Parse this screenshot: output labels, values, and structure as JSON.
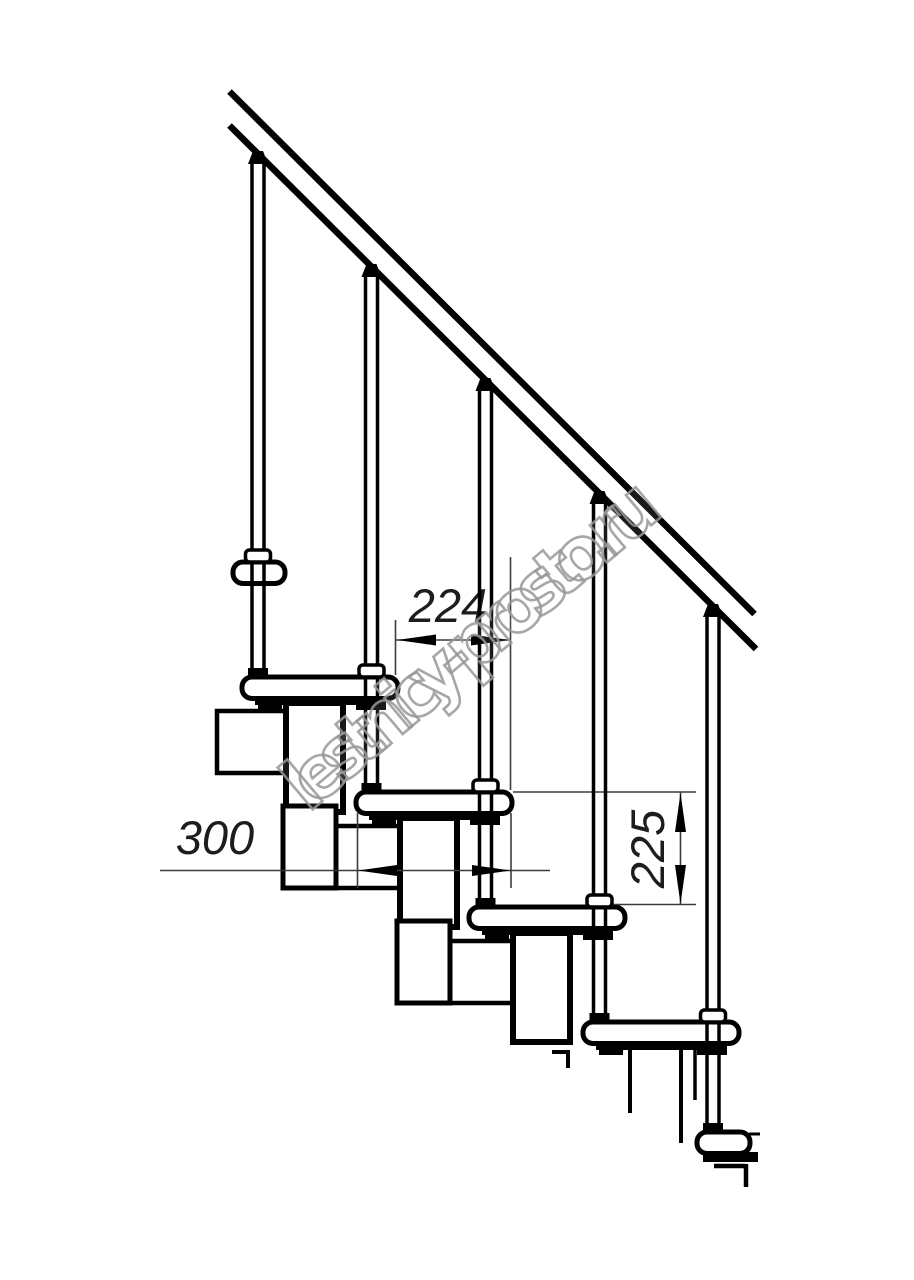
{
  "drawing": {
    "watermark": "lestnicy-prosto.ru",
    "ink_color": "#000000",
    "dim_color": "#3c3c3c",
    "watermark_color": "#989898",
    "dimensions": {
      "tread_depth_label": "300",
      "step_run_label": "224",
      "riser_height_label": "225"
    },
    "counts": {
      "balusters": 5,
      "treads": 6
    }
  }
}
